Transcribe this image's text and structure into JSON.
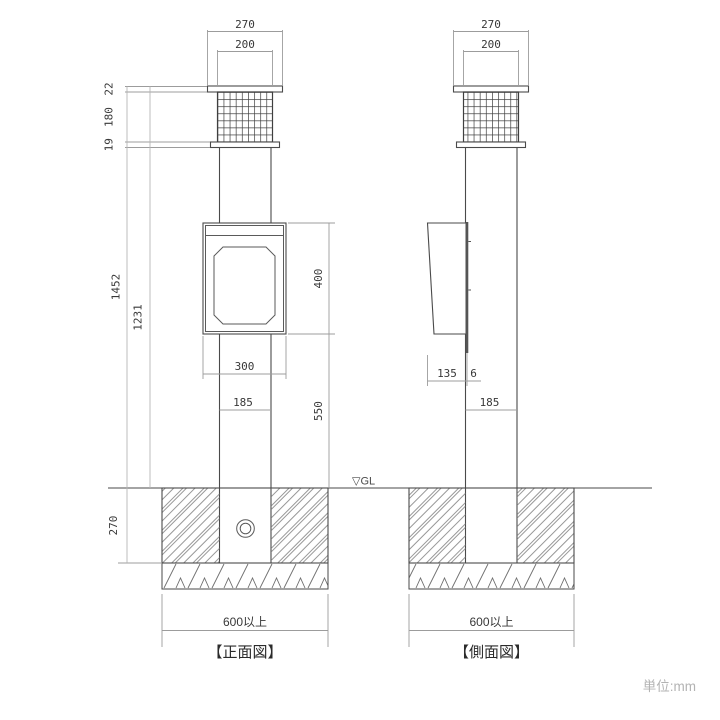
{
  "front": {
    "caption": "【正面図】",
    "gl_label": "▽GL",
    "dims": {
      "cap_width": "270",
      "lamp_width": "200",
      "cap_height": "22",
      "lamp_height": "180",
      "neck_height": "19",
      "overall_height": "1452",
      "pole_height": "1231",
      "box_height": "400",
      "box_width": "300",
      "post_width": "185",
      "box_bottom_to_gl": "550",
      "foundation_depth": "270",
      "foundation_width": "600以上"
    }
  },
  "side": {
    "caption": "【側面図】",
    "dims": {
      "cap_width": "270",
      "lamp_width": "200",
      "box_depth": "135",
      "plate_thickness": "6",
      "post_width": "185",
      "foundation_width": "600以上"
    }
  },
  "note": {
    "unit": "単位:mm"
  }
}
